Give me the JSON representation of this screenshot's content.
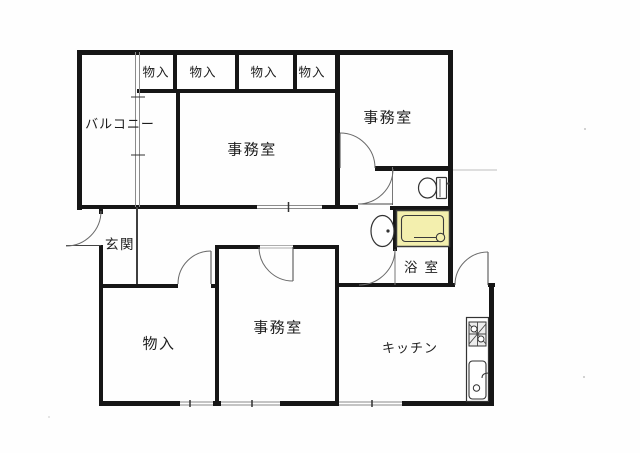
{
  "document": {
    "kind": "apartment-floor-plan",
    "language": "ja"
  },
  "rooms": {
    "closet_top_1": {
      "label": "物入"
    },
    "closet_top_2": {
      "label": "物入"
    },
    "closet_top_3": {
      "label": "物入"
    },
    "closet_top_4": {
      "label": "物入"
    },
    "balcony": {
      "label": "バルコニー"
    },
    "office_center": {
      "label": "事務室"
    },
    "office_upper_right": {
      "label": "事務室"
    },
    "entrance": {
      "label": "玄関"
    },
    "bathroom": {
      "label": "浴室"
    },
    "closet_bottom": {
      "label": "物入"
    },
    "office_bottom": {
      "label": "事務室"
    },
    "kitchen": {
      "label": "キッチン"
    }
  },
  "fixtures": {
    "toilet": "toilet-icon",
    "washbasin": "washbasin-icon",
    "bathtub": "bathtub-icon",
    "stove": "stove-icon",
    "kitchen_sink": "kitchen-sink-icon"
  },
  "colors": {
    "wall": "#161616",
    "thin_line": "#666666",
    "window_line": "#8b8b8b",
    "bathtub_fill": "#f3efae",
    "paper": "#fefefe"
  }
}
